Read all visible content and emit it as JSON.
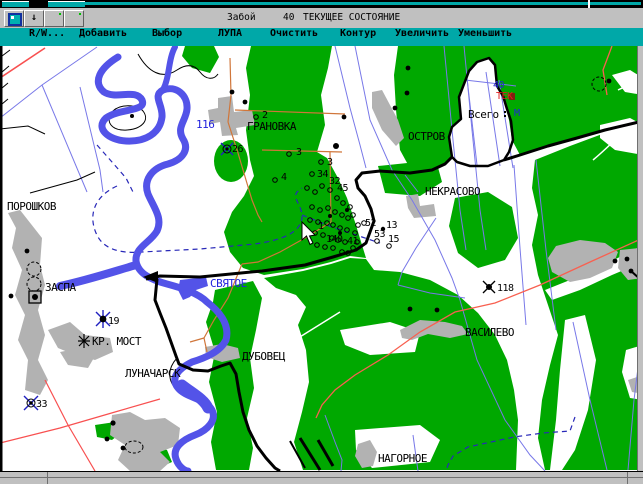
{
  "window": {
    "title": "Забой",
    "title_number": "40",
    "title_status": "ТЕКУЩЕЕ СОСТОЯНИЕ"
  },
  "toolbar": {
    "arrow_glyph": "↓"
  },
  "menu": {
    "items": [
      {
        "label": "R/W..."
      },
      {
        "label": "Добавить"
      },
      {
        "label": "Выбор"
      },
      {
        "label": "ЛУПА"
      },
      {
        "label": "Очистить"
      },
      {
        "label": "Контур"
      },
      {
        "label": "Увеличить"
      },
      {
        "label": "Уменьшить"
      }
    ]
  },
  "map": {
    "labels": {
      "poroshkov": "ПОРОШКОВ",
      "zaspa": "ЗАСПА",
      "kr_most": "КР. МОСТ",
      "lunacharsk": "ЛУНАЧАРСК",
      "svyatoe": "СВЯТОЕ",
      "dubovets": "ДУБОВЕЦ",
      "granovka": "ГРАНОВКА",
      "ostrov": "ОСТРОВ",
      "nekrasovo": "НЕКРАСОВО",
      "vasilevo": "ВАСИЛЕВО",
      "nagornoe": "НАГОРНОЕ",
      "vsego": "Всего",
      "tek": "ТЕК",
      "n40": "40",
      "m": "М",
      "n116": "116"
    },
    "wells": {
      "n26": "26",
      "n2": "2",
      "n3a": "3",
      "n3b": "3",
      "n4": "4",
      "n34": "34",
      "n32": "32",
      "n45": "45",
      "n1": "1",
      "n140": "140",
      "n41": "41",
      "n52": "52",
      "n13": "13",
      "n53": "53",
      "n15": "15",
      "n19": "19",
      "n33": "33",
      "n118": "118"
    }
  },
  "colors": {
    "menu_teal": "#00a8a8",
    "forest_green": "#00a800",
    "river_blue": "#5353e8",
    "quarter_line_blue": "#7878e8",
    "marsh_dash_blue": "#2828b8",
    "road_red": "#f85050",
    "road_orange": "#d0763a",
    "settlement_gray": "#b2b2b2",
    "frame_gray": "#c0c0c0"
  }
}
